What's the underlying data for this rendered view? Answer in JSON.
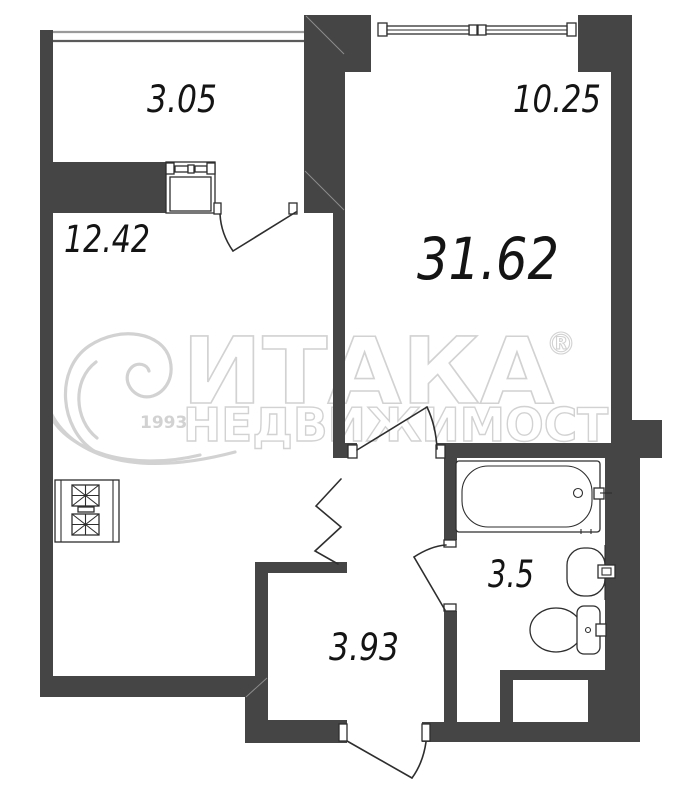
{
  "colors": {
    "wall": "#454545",
    "line": "#2e2e2e",
    "label": "#141414",
    "watermark": "#d2d2d2",
    "bg": "#ffffff"
  },
  "rooms": {
    "balcony": {
      "area": "3.05"
    },
    "room": {
      "area": "10.25"
    },
    "total": {
      "area": "31.62"
    },
    "kitchen_living": {
      "area": "12.42"
    },
    "bathroom": {
      "area": "3.5"
    },
    "hallway": {
      "area": "3.93"
    }
  },
  "watermark": {
    "brand": "ИТАКА",
    "registered": "®",
    "subtitle": "НЕДВИЖИМОСТЬ",
    "year": "1993"
  }
}
